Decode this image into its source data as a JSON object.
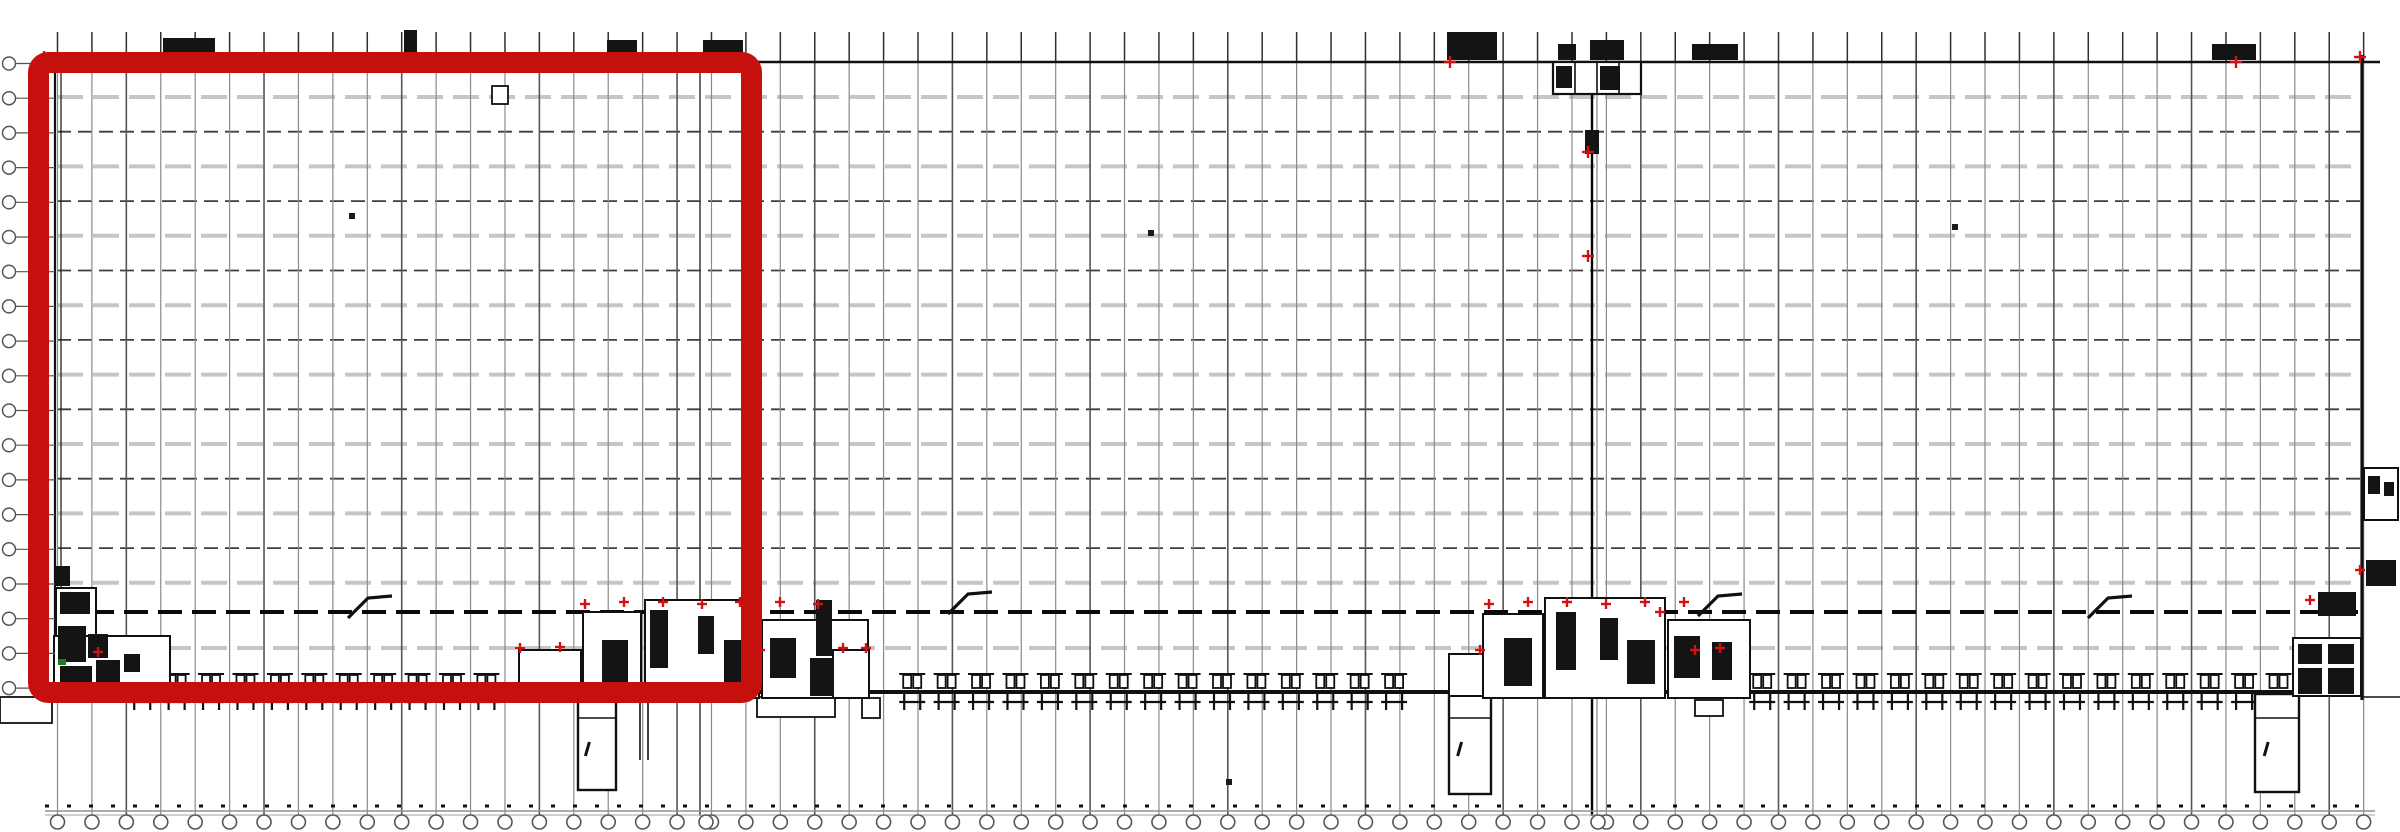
{
  "meta": {
    "description": "warehouse-floor-plan-with-red-highlight",
    "canvas": {
      "w": 2400,
      "h": 832,
      "bg": "#ffffff"
    }
  },
  "colors": {
    "wall": "#101010",
    "col_light": "#8a8a8a",
    "col_dark": "#555555",
    "col_stub": "#2f2f2f",
    "row_light": "#c6c6c6",
    "row_dark": "#3f3f3f",
    "firewall": "#0a0a0a",
    "joint": "#000000",
    "joint_thin": "#777777",
    "bubble": "#555555",
    "dock": "#101010",
    "blob": "#141414",
    "room_fill": "#ffffff",
    "highlight_red": "#c5100e",
    "mark_red": "#d21212",
    "mark_green": "#1e7d1e",
    "baseline": "#909090",
    "speck": "#1a1a1a"
  },
  "building": {
    "left": 55,
    "left2": 61,
    "right": 2362,
    "top": 62,
    "dock_wall_y": 692,
    "top_overhang_x": 2380
  },
  "grid": {
    "columns": {
      "x0": 57.5,
      "pitch": 34.42,
      "count": 68,
      "stub_top": 32,
      "wall_y": 62,
      "bottom": 816,
      "dark_every": 4
    },
    "rows": {
      "x0": 57,
      "x1": 2362,
      "y0": 97,
      "pitch": 34.7,
      "count": 15,
      "start_type": "light",
      "extra_light_y": 648
    },
    "firewall_y": 612,
    "expansion_joint_x": 1592,
    "expansion_joint_thin_x": 1597,
    "secondary_joint_x": 700
  },
  "left_bubbles": {
    "x": 9,
    "r": 6.5,
    "y0": 63.5,
    "pitch": 34.7,
    "count": 19,
    "stub_x1": 16,
    "stub_x2": 55
  },
  "bottom_bubbles": {
    "y": 822,
    "r": 7,
    "extra_x": [
      706,
      1598
    ]
  },
  "baseline": {
    "dots_y": 806,
    "line1_y": 811,
    "line2_y": 815,
    "x0": 45,
    "x1": 2375
  },
  "dock_doors": {
    "pitch": 34.42,
    "segments": [
      {
        "x0": 125,
        "x1": 508
      },
      {
        "x0": 895,
        "x1": 1442
      },
      {
        "x0": 1745,
        "x1": 2308
      }
    ]
  },
  "ramps": [
    {
      "x": 578,
      "y": 694,
      "w": 38,
      "h": 96
    },
    {
      "x": 1449,
      "y": 694,
      "w": 42,
      "h": 100
    },
    {
      "x": 2255,
      "y": 694,
      "w": 44,
      "h": 98
    }
  ],
  "extra_lines": [
    [
      640,
      694,
      640,
      760
    ],
    [
      648,
      694,
      648,
      760
    ],
    [
      2362,
      697,
      2400,
      697
    ]
  ],
  "extra_rects": [
    [
      757,
      697,
      78,
      20
    ],
    [
      0,
      697,
      52,
      26
    ],
    [
      862,
      698,
      18,
      20
    ],
    [
      1695,
      700,
      28,
      16
    ],
    [
      492,
      86,
      16,
      18
    ]
  ],
  "cores": [
    {
      "name": "core-left",
      "rects": [
        [
          56,
          588,
          40,
          48
        ],
        [
          54,
          636,
          116,
          60
        ]
      ],
      "blobs": [
        [
          56,
          566,
          14,
          20
        ],
        [
          60,
          592,
          30,
          22
        ],
        [
          58,
          626,
          28,
          36
        ],
        [
          88,
          634,
          20,
          24
        ],
        [
          60,
          666,
          32,
          28
        ],
        [
          96,
          660,
          24,
          22
        ],
        [
          124,
          654,
          16,
          18
        ]
      ],
      "red": [
        [
          98,
          652
        ]
      ],
      "green": [
        [
          62,
          662
        ]
      ]
    },
    {
      "name": "core-left-center",
      "rects": [
        [
          519,
          650,
          62,
          48
        ],
        [
          583,
          612,
          58,
          86
        ],
        [
          645,
          600,
          114,
          98
        ],
        [
          762,
          620,
          106,
          78
        ],
        [
          833,
          650,
          36,
          48
        ]
      ],
      "blobs": [
        [
          602,
          640,
          26,
          46
        ],
        [
          650,
          610,
          18,
          58
        ],
        [
          698,
          616,
          16,
          38
        ],
        [
          724,
          640,
          30,
          44
        ],
        [
          770,
          638,
          26,
          40
        ],
        [
          816,
          600,
          16,
          56
        ],
        [
          810,
          658,
          24,
          38
        ]
      ],
      "red": [
        [
          560,
          647
        ],
        [
          585,
          604
        ],
        [
          624,
          602
        ],
        [
          663,
          602
        ],
        [
          702,
          604
        ],
        [
          740,
          602
        ],
        [
          780,
          602
        ],
        [
          818,
          604
        ],
        [
          843,
          648
        ],
        [
          866,
          648
        ],
        [
          520,
          648
        ],
        [
          760,
          650
        ]
      ],
      "green": []
    },
    {
      "name": "core-center",
      "rects": [
        [
          1449,
          654,
          40,
          42
        ],
        [
          1483,
          614,
          60,
          84
        ],
        [
          1545,
          598,
          120,
          100
        ],
        [
          1668,
          620,
          82,
          78
        ]
      ],
      "blobs": [
        [
          1504,
          638,
          28,
          48
        ],
        [
          1556,
          612,
          20,
          58
        ],
        [
          1600,
          618,
          18,
          42
        ],
        [
          1627,
          640,
          28,
          44
        ],
        [
          1674,
          636,
          26,
          42
        ],
        [
          1712,
          642,
          20,
          38
        ]
      ],
      "red": [
        [
          1489,
          604
        ],
        [
          1528,
          602
        ],
        [
          1567,
          602
        ],
        [
          1606,
          604
        ],
        [
          1645,
          602
        ],
        [
          1684,
          602
        ],
        [
          1480,
          650
        ],
        [
          1695,
          650
        ],
        [
          1720,
          648
        ],
        [
          1660,
          612
        ]
      ],
      "green": []
    },
    {
      "name": "core-right",
      "rects": [
        [
          2293,
          638,
          68,
          58
        ]
      ],
      "blobs": [
        [
          2318,
          592,
          38,
          24
        ],
        [
          2298,
          644,
          24,
          20
        ],
        [
          2328,
          644,
          26,
          20
        ],
        [
          2298,
          668,
          24,
          26
        ],
        [
          2328,
          668,
          26,
          26
        ]
      ],
      "red": [
        [
          2310,
          600
        ]
      ],
      "green": []
    },
    {
      "name": "core-right-outside",
      "rects": [
        [
          2364,
          468,
          34,
          52
        ]
      ],
      "blobs": [
        [
          2368,
          476,
          12,
          18
        ],
        [
          2384,
          482,
          10,
          14
        ],
        [
          2366,
          560,
          30,
          26
        ]
      ],
      "red": [
        [
          2360,
          570
        ]
      ],
      "green": []
    }
  ],
  "top_symbols": [
    [
      163,
      38,
      52,
      22
    ],
    [
      404,
      30,
      13,
      30
    ],
    [
      607,
      40,
      30,
      20
    ],
    [
      703,
      40,
      40,
      22
    ],
    [
      1447,
      32,
      50,
      28
    ],
    [
      1692,
      44,
      46,
      16
    ],
    [
      2212,
      44,
      44,
      16
    ]
  ],
  "top_center_rooms": {
    "outline": [
      1553,
      62,
      88,
      32
    ],
    "dividers_x": [
      1575,
      1597,
      1619
    ],
    "blobs": [
      [
        1556,
        66,
        16,
        22
      ],
      [
        1600,
        66,
        20,
        24
      ],
      [
        1558,
        44,
        18,
        16
      ],
      [
        1590,
        40,
        34,
        20
      ],
      [
        1585,
        130,
        14,
        24
      ]
    ]
  },
  "flags": [
    [
      348,
      618
    ],
    [
      948,
      614
    ],
    [
      1698,
      616
    ],
    [
      2088,
      618
    ]
  ],
  "specks": [
    [
      352,
      216
    ],
    [
      1151,
      233
    ],
    [
      1955,
      227
    ],
    [
      1229,
      782
    ]
  ],
  "red_marks": [
    [
      44,
      57
    ],
    [
      1450,
      62
    ],
    [
      1588,
      152
    ],
    [
      1588,
      256
    ],
    [
      2236,
      62
    ],
    [
      2360,
      57
    ]
  ],
  "highlight": {
    "x": 38.5,
    "y": 62.5,
    "w": 713,
    "h": 630,
    "stroke_w": 21,
    "radius": 10
  }
}
